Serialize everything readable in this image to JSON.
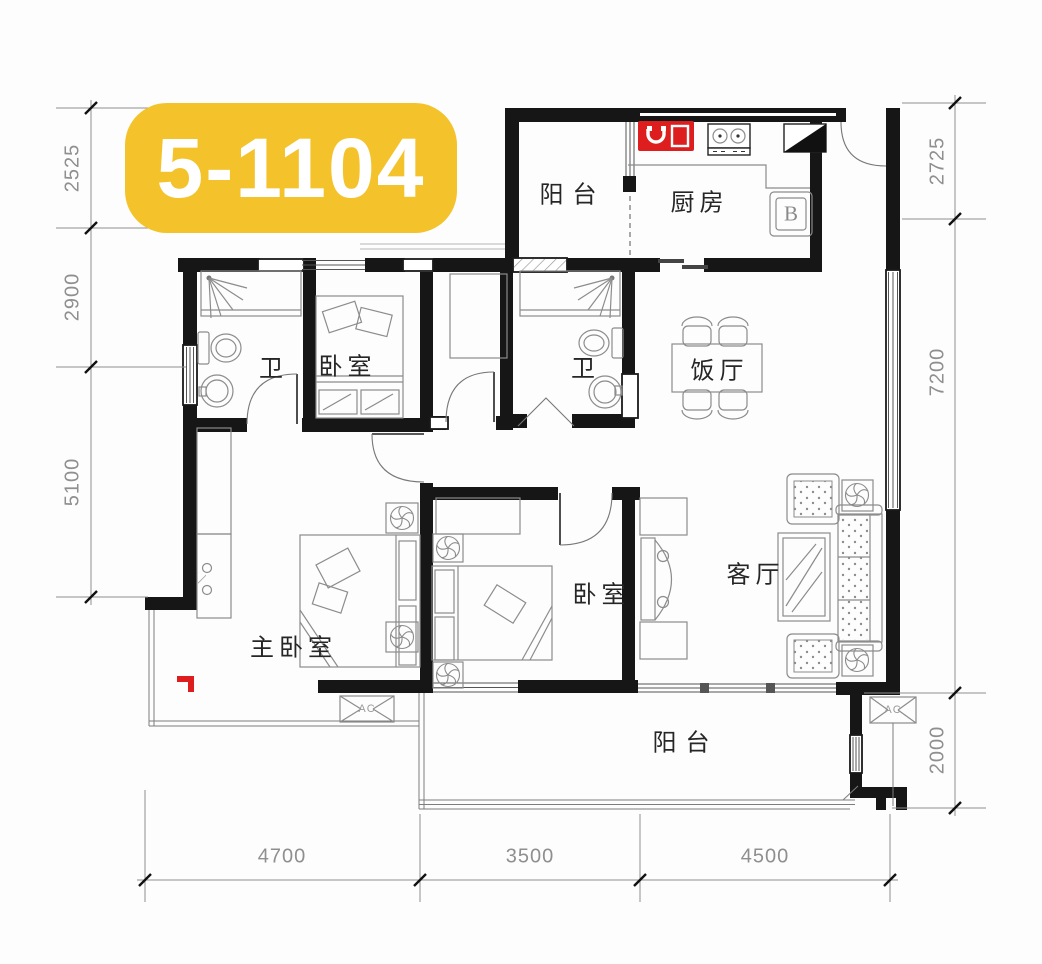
{
  "badge": {
    "label": "5-1104"
  },
  "rooms": {
    "balcony_top": "阳台",
    "kitchen": "厨房",
    "bath_left": "卫",
    "bedroom_top": "卧室",
    "bath_mid": "卫",
    "dining": "饭厅",
    "master_bedroom": "主卧室",
    "bedroom_mid": "卧室",
    "living": "客厅",
    "balcony_bottom": "阳台"
  },
  "annotations": {
    "water_heater": "B",
    "ac_left": "AC",
    "ac_right": "AC"
  },
  "dimensions": {
    "left": [
      "2525",
      "2900",
      "5100"
    ],
    "right": [
      "2725",
      "7200",
      "2000"
    ],
    "bottom": [
      "4700",
      "3500",
      "4500"
    ]
  },
  "colors": {
    "badge_bg": "#F4C32B",
    "badge_text": "#FFFFFF",
    "wall": "#161616",
    "furniture_line": "#8C8C8C",
    "dim_text": "#8F8F8F",
    "label_text": "#262626",
    "accent_red": "#DE1E1E"
  }
}
